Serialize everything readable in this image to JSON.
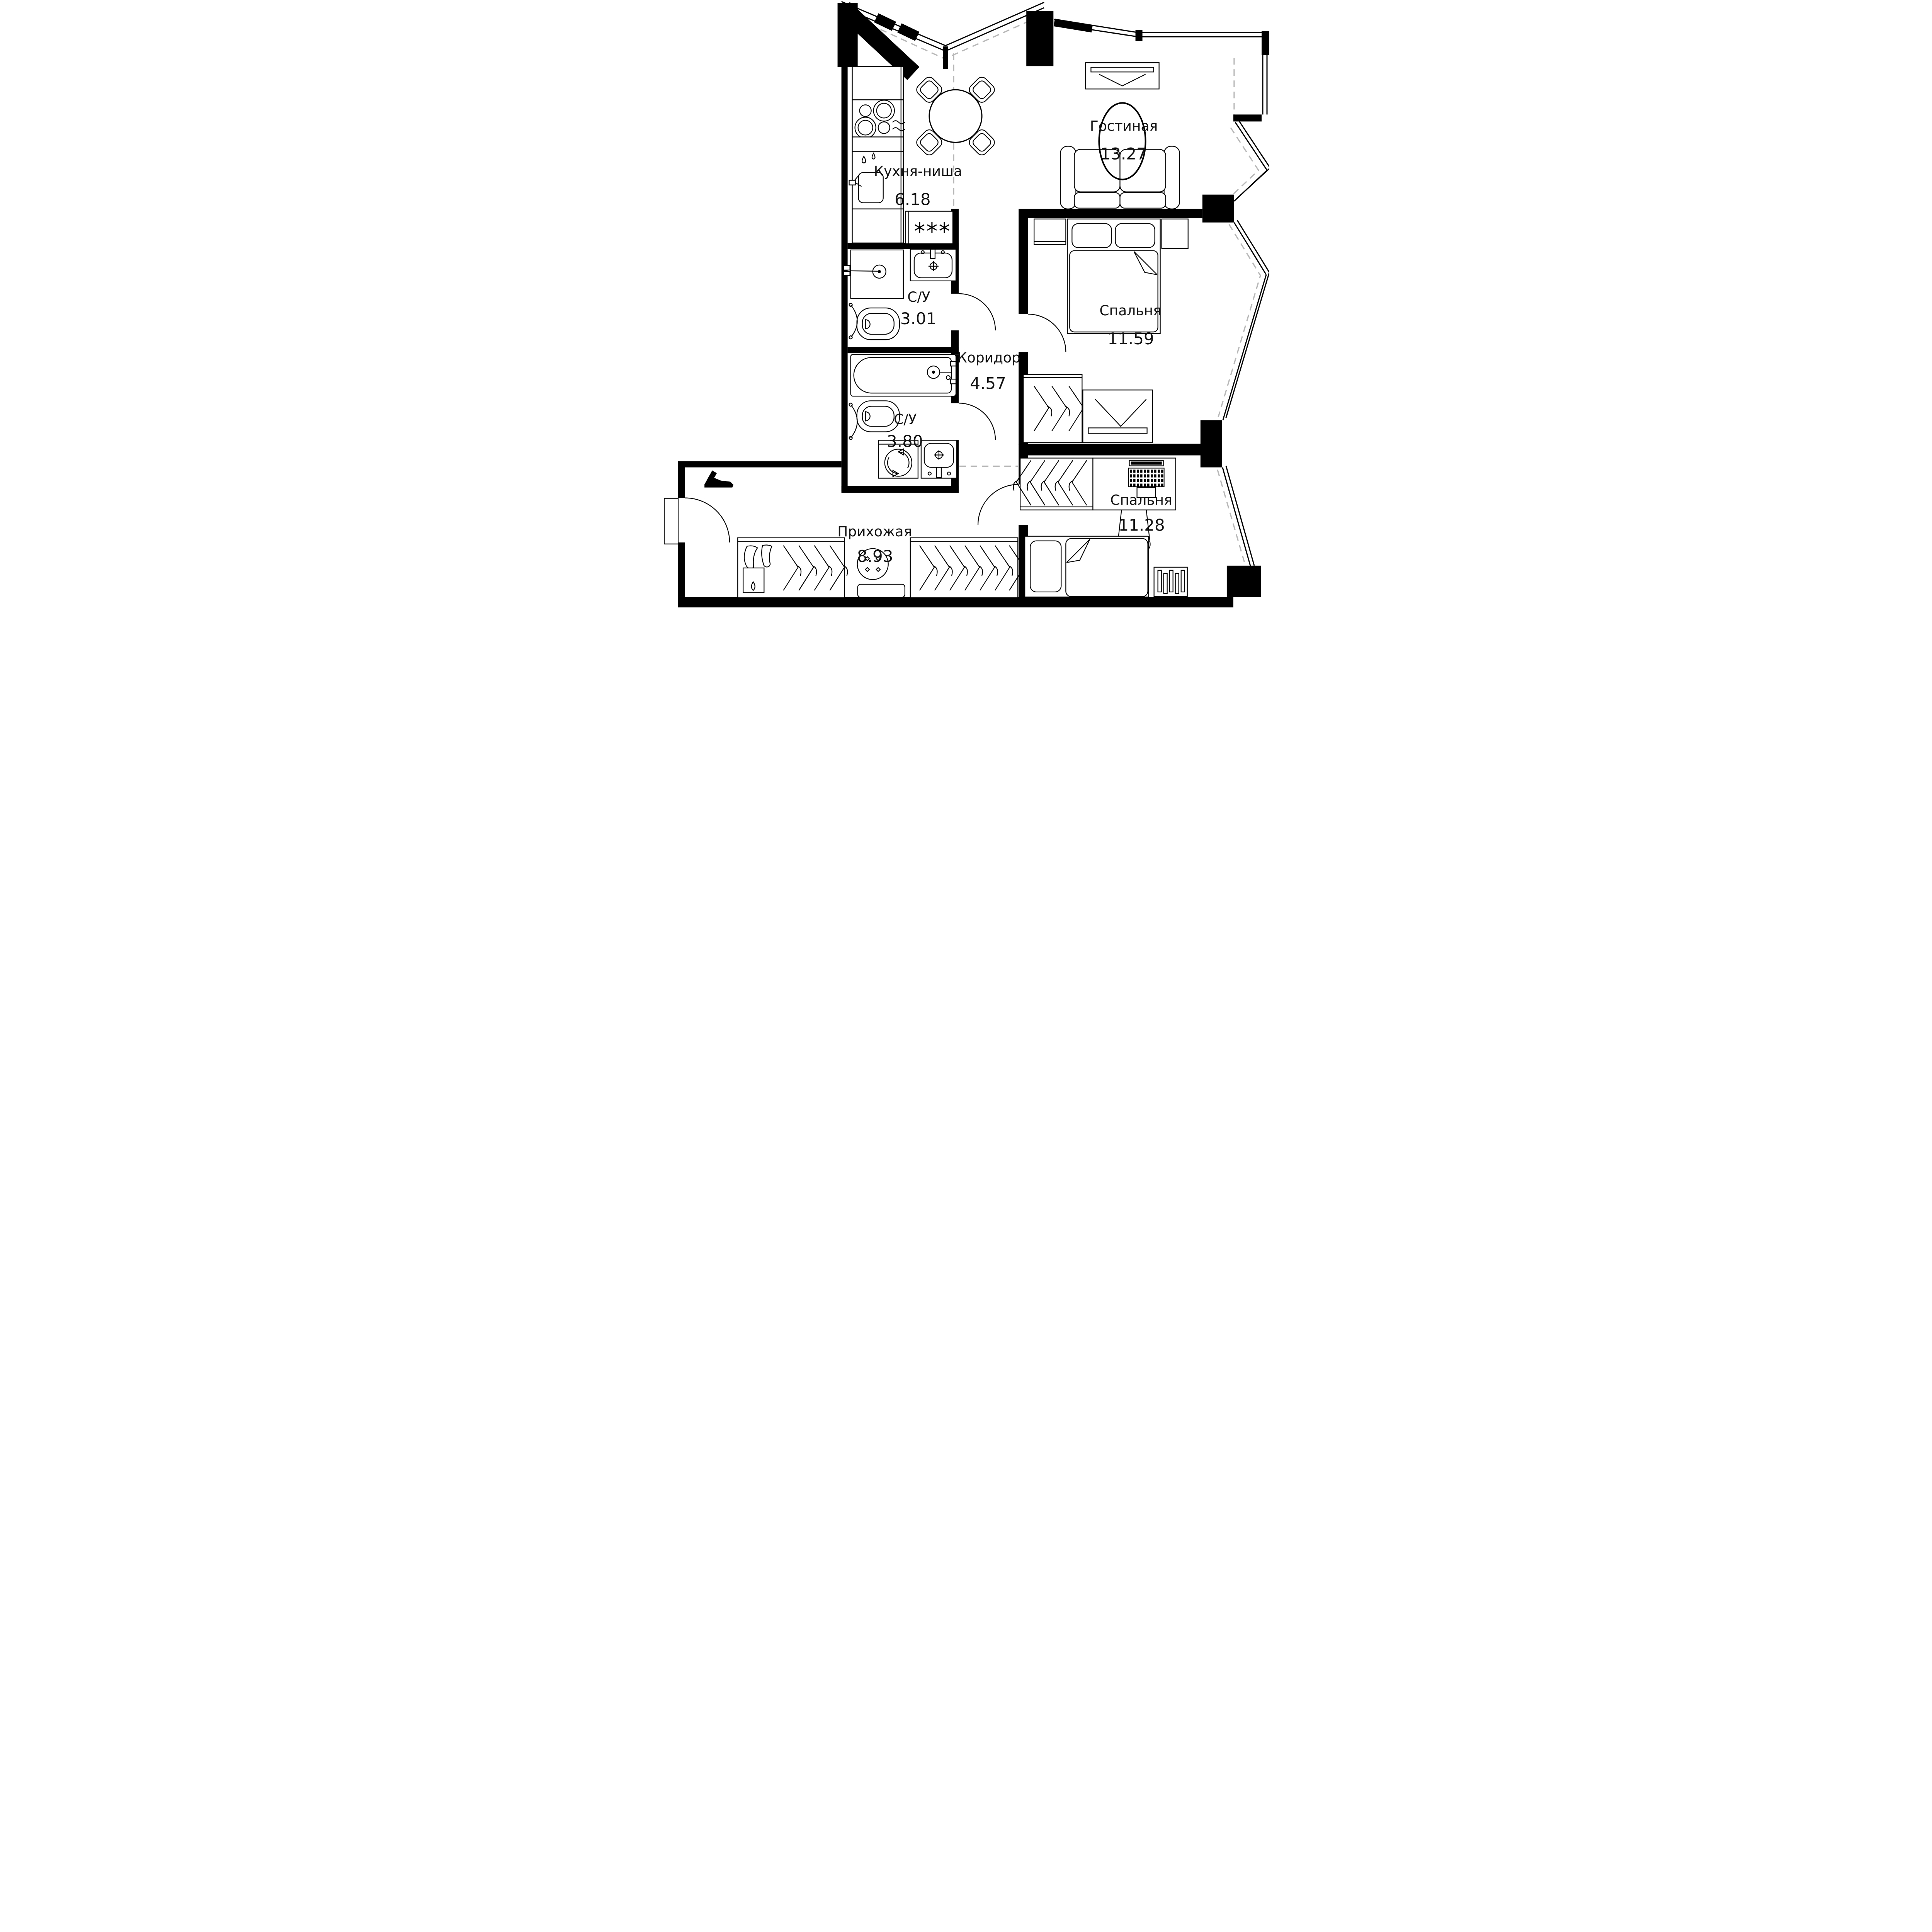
{
  "plan": {
    "title": "apartment-floor-plan",
    "rooms": [
      {
        "name": "Гостиная",
        "area": "13.27"
      },
      {
        "name": "Кухня-ниша",
        "area": "6.18"
      },
      {
        "name": "Спальня",
        "area": "11.59"
      },
      {
        "name": "С/У",
        "area": "3.01"
      },
      {
        "name": "Коридор",
        "area": "4.57"
      },
      {
        "name": "С/У",
        "area": "3.80"
      },
      {
        "name": "Прихожая",
        "area": "8.93"
      },
      {
        "name": "Спальня",
        "area": "11.28"
      }
    ],
    "icons": {
      "fridge": "three-asterisks",
      "washing_machine": "drum-with-arrows",
      "stove": "four-burners",
      "towel_dryer": "wall-arc",
      "wardrobe": "hangers",
      "tv": "v-on-stand",
      "radiator": "vertical-bars"
    },
    "colors": {
      "wall": "#000000",
      "line": "#1c1c1c",
      "zone_dash": "#b8b8b8",
      "background": "#ffffff"
    }
  }
}
